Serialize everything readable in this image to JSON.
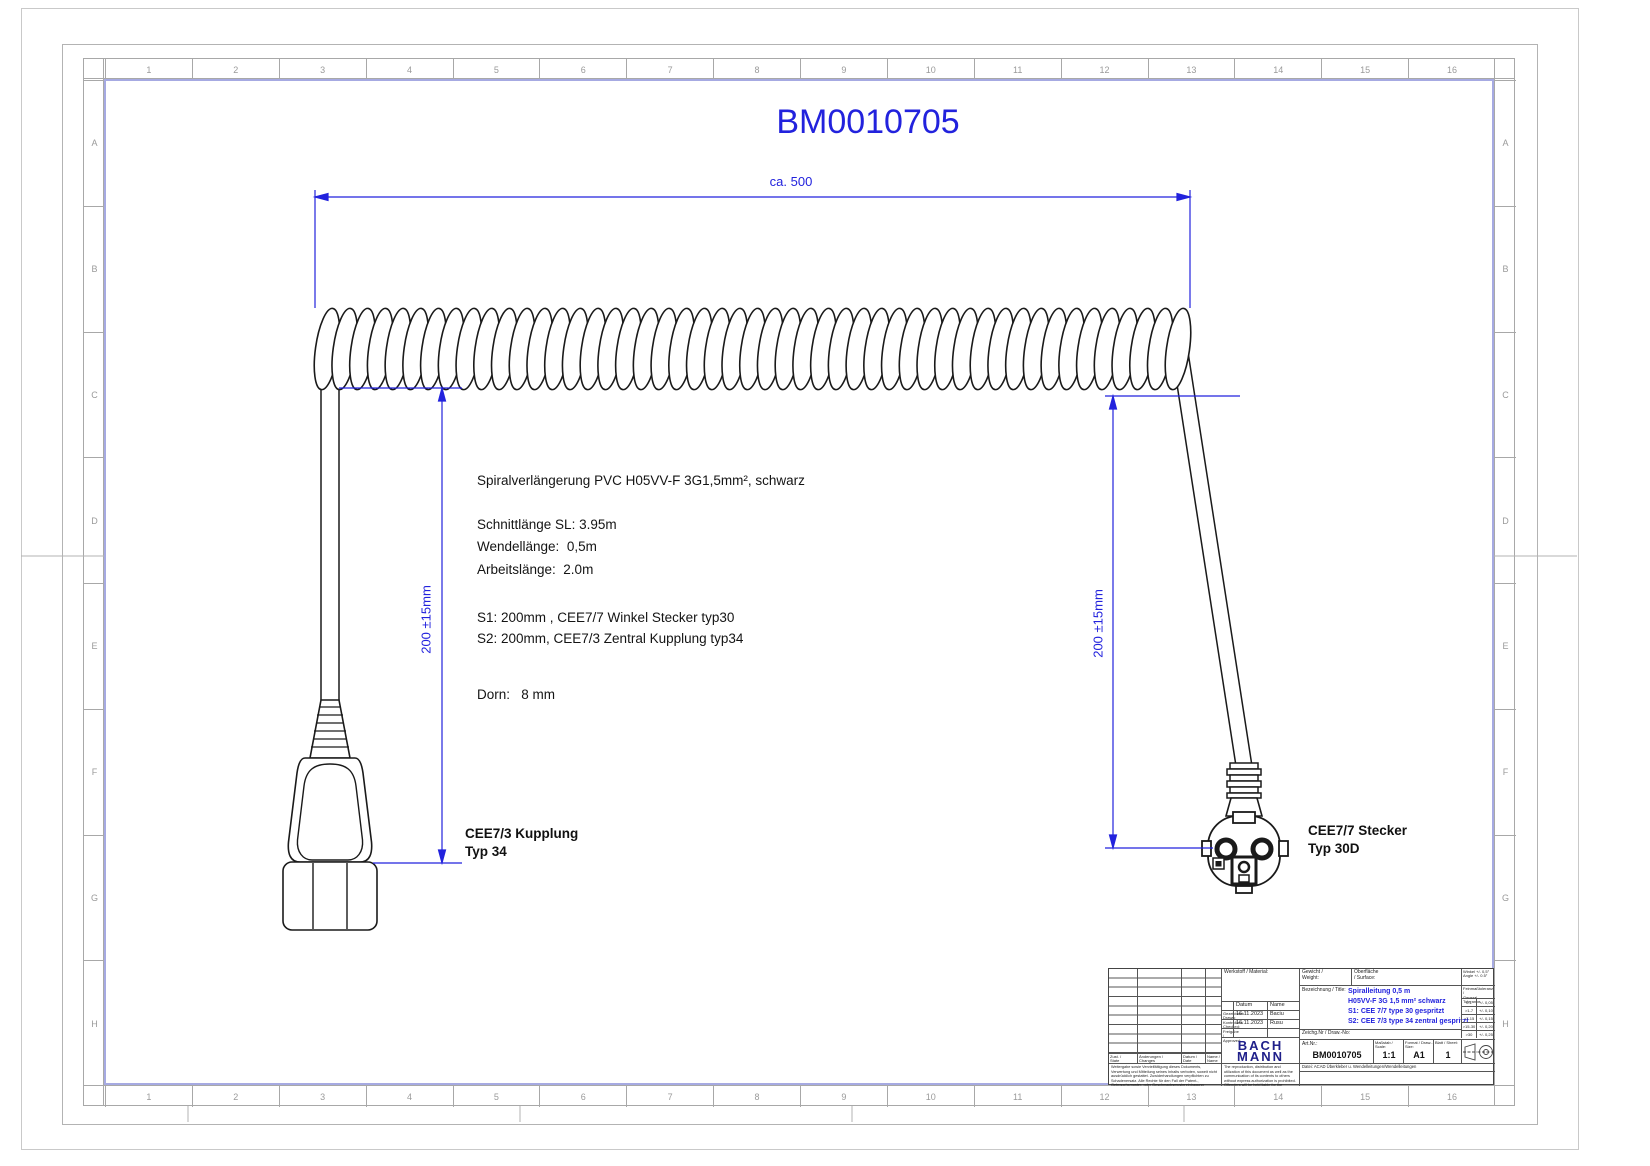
{
  "drawing": {
    "title": "BM0010705",
    "dim_overall": "ca. 500",
    "dim_left": "200 ±15mm",
    "dim_right": "200 ±15mm",
    "notes": [
      "Spiralverlängerung PVC H05VV-F 3G1,5mm², schwarz",
      "Schnittlänge SL: 3.95m",
      "Wendellänge:  0,5m",
      "Arbeitslänge:  2.0m",
      "S1: 200mm , CEE7/7 Winkel Stecker typ30",
      "S2: 200mm, CEE7/3 Zentral Kupplung typ34",
      "Dorn:   8 mm"
    ],
    "left_connector_label": "CEE7/3 Kupplung\nTyp 34",
    "right_connector_label": "CEE7/7 Stecker\nTyp 30D"
  },
  "frame": {
    "columns": [
      "1",
      "2",
      "3",
      "4",
      "5",
      "6",
      "7",
      "8",
      "9",
      "10",
      "11",
      "12",
      "13",
      "14",
      "15",
      "16"
    ],
    "rows": [
      "A",
      "B",
      "C",
      "D",
      "E",
      "F",
      "G",
      "H"
    ]
  },
  "title_block": {
    "material_label": "Werkstoff / Material:",
    "weight_label": "Gewicht /\nWeight:",
    "surface_label": "Oberfläche\n/ Surface:",
    "designation_label": "Bezeichnung / Title:",
    "designation_lines": [
      "Spiralleitung 0,5 m",
      "H05VV-F 3G 1,5 mm² schwarz",
      "S1: CEE 7/7 type 30 gespritzt",
      "S2: CEE 7/3 type 34 zentral gespritzt"
    ],
    "date_header": "Datum",
    "name_header": "Name",
    "drawn_label": "Gezeichnet/\nDrawn:",
    "drawn_date": "16.11.2023",
    "drawn_name": "Baciu",
    "checked_label": "Kontrolliert/\nChecked:",
    "checked_date": "16.11.2023",
    "checked_name": "Rusu",
    "approved_label": "Freigabe /\nApproved:",
    "drawno_label": "Zeichg.Nr / Draw.-No:",
    "brand_line1": "BACH",
    "brand_line2": "MANN",
    "artno_label": "Art.Nr.:",
    "artno_value": "BM0010705",
    "scale_label": "Maßstab / Scale:",
    "scale_value": "1:1",
    "format_label": "Format / Draw.-Size:",
    "format_value": "A1",
    "sheet_label": "Blatt / Sheet:",
    "sheet_value": "1",
    "angle_tol": "Winkel +/- 0,5°\nAngle +/- 0.5°",
    "general_tol_label": "Feinmaßtoleranz /\nGeneral Tolerance",
    "tolerances": [
      [
        "0-1",
        "+/- 0,05"
      ],
      [
        ">1-7",
        "+/- 0,10"
      ],
      [
        ">7-15",
        "+/- 0,15"
      ],
      [
        ">15-30",
        "+/- 0,20"
      ],
      [
        ">30",
        "+/- 0,25"
      ]
    ],
    "file_label": "Datei: ACAD Überkleber u. Wendelleitungen/Wendelleitungen",
    "rev_headers": [
      "Zust. /\nState",
      "Änderungen /\nChanges",
      "Datum /\nDate",
      "Name /\nName"
    ],
    "legal_de": "Weitergabe sowie Vervielfältigung dieses Dokuments, Verwertung und Mitteilung seines Inhalts verboten, soweit nicht ausdrücklich gestattet. Zuwiderhandlungen verpflichten zu Schadenersatz. Alle Rechte für den Fall der Patent-, Gebrauchsmuster- oder Geschmacksmustereintragung vorbehalten.",
    "legal_en": "The reproduction, distribution and utilization of this document as well as the communication of its contents to others without express authorization is prohibited. Offenders will be held liable for the payment of damages. All rights reserved in the event of the grant of a patent, utility model or design."
  },
  "colors": {
    "dimension_blue": "#2222dd",
    "brand_blue": "#20208a",
    "line_black": "#1a1a1a",
    "frame_gray": "#a8a8a8",
    "inner_frame_violet": "#a6aae2"
  }
}
